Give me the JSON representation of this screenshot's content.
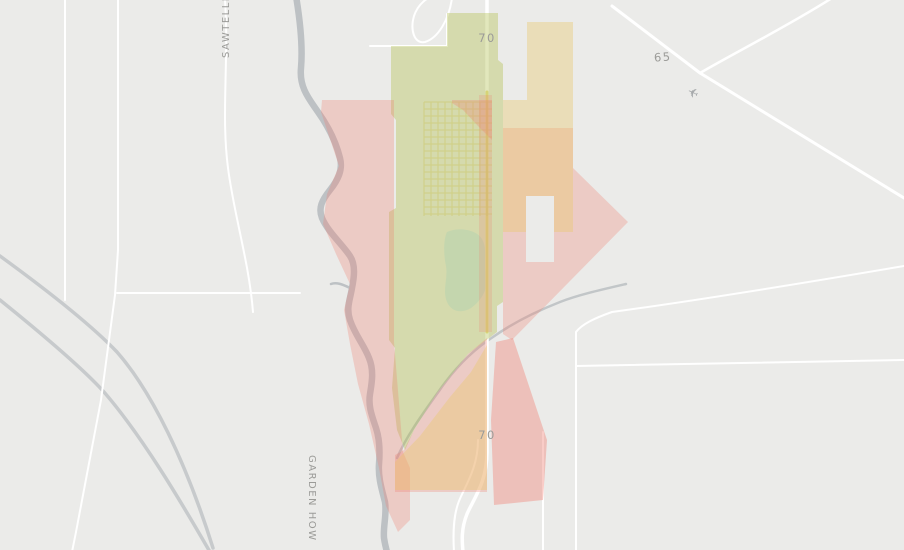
{
  "map": {
    "width": 904,
    "height": 550,
    "background": "#ebebe9",
    "palette": {
      "base": "#ebebe9",
      "road_white": "#ffffff",
      "road_gray": "#c7cacc",
      "river_gray": "#bdc1c4",
      "stream_gray": "#c2c6c8",
      "highway_yellow": "#ece08f",
      "overlay_pink": "#ef8074",
      "overlay_green": "#a9b93c",
      "overlay_tan": "#e9c76a",
      "lake_blue": "#cfe4ea",
      "label_gray": "#9b9b98",
      "icon_gray": "#a7aaac",
      "town_grid": "#e2d694"
    },
    "labels": [
      {
        "name": "road-label-70-top",
        "text": "70",
        "x": 487,
        "y": 42,
        "size": 11.5,
        "rotate": 0
      },
      {
        "name": "road-label-70-bottom",
        "text": "70",
        "x": 487,
        "y": 439,
        "size": 11.5,
        "rotate": 0
      },
      {
        "name": "road-label-65",
        "text": "65",
        "x": 663,
        "y": 61,
        "size": 11.5,
        "rotate": -4
      },
      {
        "name": "road-label-sawtelle",
        "text": "SAWTELLE",
        "x": 229,
        "y": 58,
        "size": 10,
        "rotate": -90
      },
      {
        "name": "road-label-garden",
        "text": "GARDEN HOW",
        "x": 309,
        "y": 455,
        "size": 10,
        "rotate": 90
      }
    ],
    "icons": [
      {
        "name": "airport-icon",
        "glyph": "✈",
        "x": 691,
        "y": 97,
        "size": 13,
        "rotate": -25,
        "flip": true,
        "fill": "#a7aaac"
      }
    ],
    "layers": [
      {
        "kind": "fillpath",
        "name": "lake",
        "d": "M447,232 C458,227 476,229 482,239 C488,250 483,262 486,274 C489,288 482,300 471,308 C459,315 449,310 446,299 C443,288 448,278 446,266 C443,252 444,238 447,232 Z",
        "fill": "#cfe4ea",
        "opacity": 0.9
      },
      {
        "kind": "path",
        "name": "river",
        "d": "M296,-4 C300,20 303,45 301,68 C299,88 310,100 318,112 C328,126 336,142 340,158 C343,170 338,180 330,190 C322,200 318,208 322,218 C328,232 342,244 350,256 C356,265 354,278 352,288 C350,300 346,308 350,320 C355,335 364,345 369,358 C374,370 372,382 370,394 C368,406 372,416 376,428 C380,440 380,452 379,464 C378,478 382,490 385,502 C387,514 383,526 384,538 C385,545 386,548 387,552",
        "stroke": "#bdc1c4",
        "width": 6.5
      },
      {
        "kind": "path",
        "name": "river-spur",
        "d": "M350,288 C342,284 336,282 331,284",
        "stroke": "#bdc1c4",
        "width": 2.5
      },
      {
        "kind": "path",
        "name": "stream-east",
        "d": "M626,284 C600,290 578,295 560,302 C532,313 510,325 493,337 C470,352 452,372 439,391 C421,416 406,437 397,458",
        "stroke": "#c2c6c8",
        "width": 2.5
      },
      {
        "kind": "path",
        "name": "gray-road-southwest-1",
        "d": "M0,256 C55,296 96,330 117,352 C152,392 186,462 213,548",
        "stroke": "#c7cacc",
        "width": 3.5
      },
      {
        "kind": "path",
        "name": "gray-road-southwest-2",
        "d": "M0,300 C52,342 86,372 104,392 C142,436 180,500 210,552",
        "stroke": "#c7cacc",
        "width": 3.5
      },
      {
        "kind": "path",
        "name": "road-vertical-west-1",
        "d": "M65,0 L65,300",
        "stroke": "#ffffff",
        "width": 2
      },
      {
        "kind": "path",
        "name": "road-vertical-west-2",
        "d": "M118,0 L118,250 L115,295 L101,400 L76,532 L72,552",
        "stroke": "#ffffff",
        "width": 2
      },
      {
        "kind": "path",
        "name": "road-horizontal-west",
        "d": "M117,293 L300,293",
        "stroke": "#ffffff",
        "width": 2
      },
      {
        "kind": "path",
        "name": "sawtelle-road",
        "d": "M225,0 C229,60 221,115 228,168 C234,215 249,262 253,312",
        "stroke": "#ffffff",
        "width": 2
      },
      {
        "kind": "path",
        "name": "road-loop-north",
        "d": "M452,-2 C449,20 438,38 425,42 C414,44 410,30 414,16 C418,4 428,-4 436,-4",
        "stroke": "#ffffff",
        "width": 2
      },
      {
        "kind": "path",
        "name": "road-top-horizontal",
        "d": "M370,46 L447,46",
        "stroke": "#ffffff",
        "width": 2
      },
      {
        "kind": "path",
        "name": "road-top-vertical",
        "d": "M447,14 L447,46",
        "stroke": "#ffffff",
        "width": 2
      },
      {
        "kind": "path",
        "name": "highway-65-west-branch",
        "d": "M612,6 L700,73",
        "stroke": "#ffffff",
        "width": 3
      },
      {
        "kind": "path",
        "name": "highway-65-north-branch",
        "d": "M832,-2 C788,26 736,52 700,73",
        "stroke": "#ffffff",
        "width": 2.5
      },
      {
        "kind": "path",
        "name": "highway-65-southeast",
        "d": "M700,73 L904,198",
        "stroke": "#ffffff",
        "width": 3
      },
      {
        "kind": "path",
        "name": "road-east-1",
        "d": "M904,266 C810,282 700,300 612,312 C595,318 582,324 576,332 L576,366",
        "stroke": "#ffffff",
        "width": 2
      },
      {
        "kind": "path",
        "name": "road-east-2",
        "d": "M576,366 L904,360",
        "stroke": "#ffffff",
        "width": 2
      },
      {
        "kind": "path",
        "name": "road-east-vertical",
        "d": "M576,366 L576,552",
        "stroke": "#ffffff",
        "width": 2
      },
      {
        "kind": "path",
        "name": "road-south-vertical",
        "d": "M543,432 L543,552",
        "stroke": "#ffffff",
        "width": 2
      },
      {
        "kind": "path",
        "name": "highway-70-road",
        "d": "M487,0 L487,452 C487,482 474,498 467,514 C461,529 462,541 463,552",
        "stroke": "#ffffff",
        "width": 3.5
      },
      {
        "kind": "path",
        "name": "highway-70-frontage",
        "d": "M478,440 C478,468 465,486 459,501 C453,516 453,535 454,552",
        "stroke": "#ffffff",
        "width": 2
      },
      {
        "kind": "path",
        "name": "highway-70-yellow-segment",
        "d": "M487,92 L487,332",
        "stroke": "#ece08f",
        "width": 3,
        "opacity": 0.95
      },
      {
        "kind": "grid",
        "name": "town-street-grid",
        "x": 424,
        "y": 102,
        "w": 68,
        "h": 114,
        "step": 7,
        "stroke": "#e2d694",
        "width": 1,
        "opacity": 0.75
      },
      {
        "kind": "polygon",
        "name": "coverage-green-central",
        "points": "447,13 498,13 498,60 503,64 503,302 497,306 497,332 468,354 437,393 414,430 405,450 397,430 392,388 395,348 389,340 389,212 396,208 396,120 391,114 391,46 447,46",
        "fill": "#a9b93c",
        "opacity": 0.34
      },
      {
        "kind": "polygon",
        "name": "coverage-pink-river-band",
        "points": "321,112 322,100 394,100 394,342 403,452 410,468 410,520 398,532 386,506 379,468 369,424 358,384 350,344 344,310 350,284 336,254 323,224 327,194 339,166 329,136",
        "fill": "#ef8074",
        "opacity": 0.3
      },
      {
        "kind": "polygon",
        "name": "coverage-pink-top-center",
        "points": "452,100 492,100 492,140 478,126 463,110 452,103",
        "fill": "#ef8074",
        "opacity": 0.3
      },
      {
        "kind": "polygon",
        "name": "coverage-pink-highway-stripe",
        "points": "479,95 492,95 492,332 479,332",
        "fill": "#ef8074",
        "opacity": 0.22
      },
      {
        "kind": "polygon",
        "name": "coverage-pink-east-triangle",
        "points": "503,128 573,128 573,168 628,222 512,340 503,334",
        "fill": "#ef8074",
        "opacity": 0.3
      },
      {
        "kind": "polygon",
        "name": "coverage-pink-south-mid",
        "points": "487,338 487,492 395,492 395,455 404,450 414,430 437,393 468,354",
        "fill": "#ef8074",
        "opacity": 0.3
      },
      {
        "kind": "polygon",
        "name": "coverage-pink-south-wedge",
        "points": "496,342 513,338 547,440 543,500 494,505 491,420",
        "fill": "#ef8074",
        "opacity": 0.4
      },
      {
        "kind": "polygon",
        "name": "coverage-tan-northeast",
        "points": "527,22 573,22 573,232 503,232 503,100 527,100",
        "fill": "#e9c76a",
        "opacity": 0.38
      },
      {
        "kind": "polygon",
        "name": "coverage-tan-south",
        "points": "487,345 487,490 395,490 395,462 420,436 450,397 471,372",
        "fill": "#e9c76a",
        "opacity": 0.38
      },
      {
        "kind": "rect",
        "name": "coverage-gap-notch",
        "x": 526,
        "y": 196,
        "w": 28,
        "h": 66,
        "fill": "#ebebe9",
        "opacity": 1
      }
    ]
  }
}
